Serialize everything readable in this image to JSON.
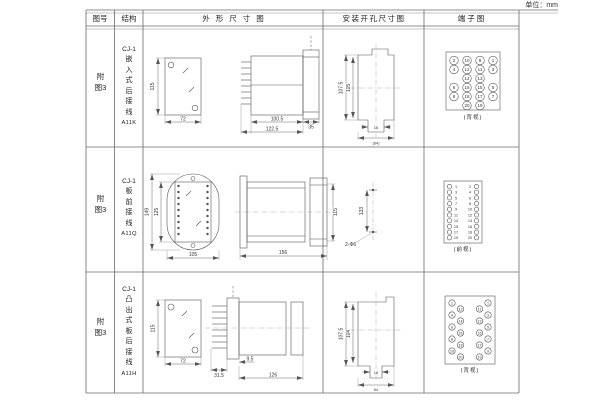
{
  "unit_label": "单位：mm",
  "header": {
    "figure": "图号",
    "structure": "结构",
    "outline": "外形尺寸图",
    "mounting": "安装开孔尺寸图",
    "terminal": "端子图"
  },
  "rows": [
    {
      "figure": "附图3",
      "model": "CJ-1",
      "structure": "嵌入式后接线",
      "code": "A11K",
      "outline_dims": {
        "height": "115",
        "width": "72",
        "case_depth": "100.5",
        "total_depth": "122.5",
        "rear_depth": "35"
      },
      "mounting_dims": {
        "outer_height": "107.5",
        "inner_height": "105",
        "slot_width": "16",
        "opening_width": "(64)"
      },
      "terminal": {
        "caption": "(背视)",
        "grid": [
          [
            "2",
            "10",
            "9",
            "1"
          ],
          [
            "4",
            "12",
            "11",
            "3"
          ],
          [
            "",
            "14",
            "13",
            ""
          ],
          [
            "6",
            "16",
            "15",
            "5"
          ],
          [
            "8",
            "18",
            "17",
            "7"
          ],
          [
            "",
            "20",
            "19",
            ""
          ]
        ]
      }
    },
    {
      "figure": "附图3",
      "model": "CJ-1",
      "structure": "板前接线",
      "code": "A11Q",
      "outline_dims": {
        "flange_height": "149",
        "body_height": "125",
        "width": "105",
        "depth": "156",
        "side_height": "115"
      },
      "mounting_dims": {
        "hole_spacing": "133",
        "holes": "2-Φ6"
      },
      "terminal": {
        "caption": "(前视)",
        "grid": [
          [
            "1",
            "2"
          ],
          [
            "3",
            "4"
          ],
          [
            "5",
            "6"
          ],
          [
            "7",
            "8"
          ],
          [
            "9",
            "10"
          ],
          [
            "11",
            "12"
          ],
          [
            "13",
            "14"
          ],
          [
            "15",
            "16"
          ],
          [
            "17",
            "18"
          ],
          [
            "19",
            "20"
          ]
        ]
      }
    },
    {
      "figure": "附图3",
      "model": "CJ-1",
      "structure": "凸出式板后接线",
      "code": "A11H",
      "outline_dims": {
        "height": "115",
        "width": "72",
        "pin_depth": "31.5",
        "plate_depth": "9.5",
        "body_depth": "126"
      },
      "mounting_dims": {
        "outer_height": "107.5",
        "inner_height": "104",
        "slot_width": "16",
        "opening_width": "64"
      },
      "terminal": {
        "caption": "(背视)",
        "grid_left": [
          [
            "2",
            "12"
          ],
          [
            "4",
            "14"
          ],
          [
            "6",
            "16"
          ],
          [
            "8",
            "18"
          ],
          [
            "10",
            "20"
          ]
        ],
        "grid_right": [
          [
            "11",
            "1"
          ],
          [
            "13",
            "3"
          ],
          [
            "15",
            "5"
          ],
          [
            "17",
            "7"
          ],
          [
            "19",
            "9"
          ]
        ]
      }
    }
  ]
}
